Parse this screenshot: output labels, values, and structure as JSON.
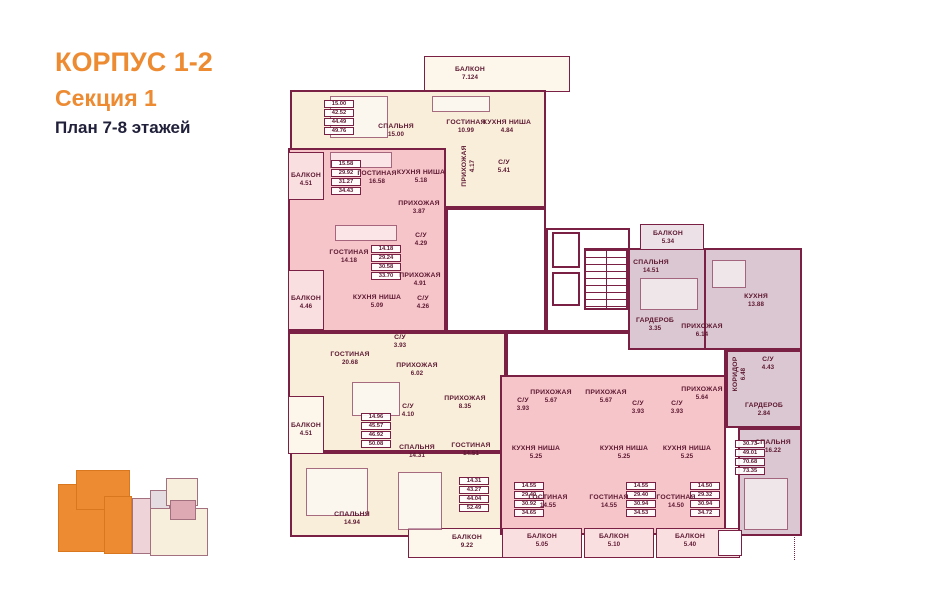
{
  "header": {
    "building": "КОРПУС 1-2",
    "section": "Секция 1",
    "plan": "План 7-8 этажей"
  },
  "palette": {
    "wall": "#7a2044",
    "label": "#5c1730",
    "orange": "#ED8B33",
    "cream": "#f8eeda",
    "pink": "#f5c5c9",
    "mauve": "#dbc7d1",
    "balcony_cream": "#fcf7ea",
    "balcony_pink": "#fadfe1",
    "balcony_mauve": "#ece1e7",
    "corridor": "#ffffff"
  },
  "plan": {
    "slabs": [
      {
        "x": 424,
        "y": 56,
        "w": 146,
        "h": 36,
        "f": "balcony_cream",
        "thin": 1,
        "n": "balcony"
      },
      {
        "x": 290,
        "y": 90,
        "w": 256,
        "h": 118,
        "f": "cream",
        "n": "apartment-zone"
      },
      {
        "x": 288,
        "y": 148,
        "w": 158,
        "h": 184,
        "f": "pink",
        "n": "apartment-zone"
      },
      {
        "x": 288,
        "y": 332,
        "w": 218,
        "h": 120,
        "f": "cream",
        "n": "apartment-zone"
      },
      {
        "x": 290,
        "y": 452,
        "w": 216,
        "h": 85,
        "f": "cream",
        "n": "apartment-zone"
      },
      {
        "x": 288,
        "y": 152,
        "w": 36,
        "h": 48,
        "f": "balcony_pink",
        "thin": 1,
        "n": "balcony"
      },
      {
        "x": 288,
        "y": 270,
        "w": 36,
        "h": 60,
        "f": "balcony_pink",
        "thin": 1,
        "n": "balcony"
      },
      {
        "x": 288,
        "y": 396,
        "w": 36,
        "h": 58,
        "f": "balcony_cream",
        "thin": 1,
        "n": "balcony"
      },
      {
        "x": 408,
        "y": 528,
        "w": 100,
        "h": 30,
        "f": "balcony_cream",
        "thin": 1,
        "n": "balcony"
      },
      {
        "x": 446,
        "y": 208,
        "w": 100,
        "h": 124,
        "f": "corridor",
        "n": "corridor"
      },
      {
        "x": 546,
        "y": 228,
        "w": 84,
        "h": 104,
        "f": "corridor",
        "n": "corridor"
      },
      {
        "x": 506,
        "y": 332,
        "w": 220,
        "h": 60,
        "f": "corridor",
        "n": "corridor"
      },
      {
        "x": 500,
        "y": 375,
        "w": 226,
        "h": 160,
        "f": "pink",
        "n": "apartment-zone"
      },
      {
        "x": 502,
        "y": 528,
        "w": 80,
        "h": 30,
        "f": "balcony_pink",
        "thin": 1,
        "n": "balcony"
      },
      {
        "x": 584,
        "y": 528,
        "w": 70,
        "h": 30,
        "f": "balcony_pink",
        "thin": 1,
        "n": "balcony"
      },
      {
        "x": 656,
        "y": 528,
        "w": 84,
        "h": 30,
        "f": "balcony_pink",
        "thin": 1,
        "n": "balcony"
      },
      {
        "x": 628,
        "y": 248,
        "w": 78,
        "h": 102,
        "f": "mauve",
        "n": "apartment-zone"
      },
      {
        "x": 704,
        "y": 248,
        "w": 98,
        "h": 102,
        "f": "mauve",
        "n": "apartment-zone"
      },
      {
        "x": 726,
        "y": 350,
        "w": 76,
        "h": 78,
        "f": "mauve",
        "n": "apartment-zone"
      },
      {
        "x": 738,
        "y": 428,
        "w": 64,
        "h": 108,
        "f": "mauve",
        "n": "apartment-zone"
      },
      {
        "x": 640,
        "y": 224,
        "w": 64,
        "h": 26,
        "f": "balcony_mauve",
        "thin": 1,
        "n": "balcony"
      },
      {
        "x": 552,
        "y": 232,
        "w": 28,
        "h": 36,
        "f": "corridor",
        "n": "elevator"
      },
      {
        "x": 552,
        "y": 272,
        "w": 28,
        "h": 34,
        "f": "corridor",
        "n": "elevator"
      },
      {
        "x": 718,
        "y": 530,
        "w": 24,
        "h": 26,
        "f": "corridor",
        "thin": 1,
        "n": "balcony"
      }
    ],
    "stairs": {
      "x": 584,
      "y": 248,
      "w": 44,
      "h": 62
    },
    "dotted": {
      "x": 794,
      "y": 534,
      "h": 26
    },
    "furniture": [
      {
        "x": 330,
        "y": 96,
        "w": 58,
        "h": 42
      },
      {
        "x": 432,
        "y": 96,
        "w": 58,
        "h": 16
      },
      {
        "x": 330,
        "y": 152,
        "w": 62,
        "h": 16
      },
      {
        "x": 335,
        "y": 225,
        "w": 62,
        "h": 16
      },
      {
        "x": 352,
        "y": 382,
        "w": 48,
        "h": 34
      },
      {
        "x": 306,
        "y": 468,
        "w": 62,
        "h": 48
      },
      {
        "x": 398,
        "y": 472,
        "w": 44,
        "h": 58
      },
      {
        "x": 640,
        "y": 278,
        "w": 58,
        "h": 32
      },
      {
        "x": 712,
        "y": 260,
        "w": 34,
        "h": 28
      },
      {
        "x": 744,
        "y": 478,
        "w": 44,
        "h": 52
      }
    ],
    "rooms": [
      {
        "l": "БАЛКОН",
        "a": "7.124",
        "x": 470,
        "y": 74
      },
      {
        "l": "СПАЛЬНЯ",
        "a": "15.00",
        "x": 396,
        "y": 131
      },
      {
        "l": "ГОСТИНАЯ",
        "a": "10.99",
        "x": 466,
        "y": 127
      },
      {
        "l": "КУХНЯ НИША",
        "a": "4.84",
        "x": 507,
        "y": 127
      },
      {
        "l": "ПРИХОЖАЯ",
        "a": "4.17",
        "x": 469,
        "y": 166,
        "v": 1
      },
      {
        "l": "С/У",
        "a": "5.41",
        "x": 504,
        "y": 167
      },
      {
        "l": "БАЛКОН",
        "a": "4.51",
        "x": 306,
        "y": 180
      },
      {
        "l": "ГОСТИНАЯ",
        "a": "16.58",
        "x": 377,
        "y": 178
      },
      {
        "l": "КУХНЯ НИША",
        "a": "5.18",
        "x": 421,
        "y": 177
      },
      {
        "l": "ПРИХОЖАЯ",
        "a": "3.87",
        "x": 419,
        "y": 208
      },
      {
        "l": "С/У",
        "a": "4.29",
        "x": 421,
        "y": 240
      },
      {
        "l": "ГОСТИНАЯ",
        "a": "14.18",
        "x": 349,
        "y": 257
      },
      {
        "l": "БАЛКОН",
        "a": "4.46",
        "x": 306,
        "y": 303
      },
      {
        "l": "КУХНЯ НИША",
        "a": "5.09",
        "x": 377,
        "y": 302
      },
      {
        "l": "ПРИХОЖАЯ",
        "a": "4.91",
        "x": 420,
        "y": 280
      },
      {
        "l": "С/У",
        "a": "4.26",
        "x": 423,
        "y": 303
      },
      {
        "l": "ГОСТИНАЯ",
        "a": "20.68",
        "x": 350,
        "y": 359
      },
      {
        "l": "С/У",
        "a": "3.93",
        "x": 400,
        "y": 342
      },
      {
        "l": "ПРИХОЖАЯ",
        "a": "6.02",
        "x": 417,
        "y": 370
      },
      {
        "l": "БАЛКОН",
        "a": "4.51",
        "x": 306,
        "y": 430
      },
      {
        "l": "С/У",
        "a": "4.10",
        "x": 408,
        "y": 411
      },
      {
        "l": "ПРИХОЖАЯ",
        "a": "8.35",
        "x": 465,
        "y": 403
      },
      {
        "l": "СПАЛЬНЯ",
        "a": "14.31",
        "x": 417,
        "y": 452
      },
      {
        "l": "ГОСТИНАЯ",
        "a": "14.51",
        "x": 471,
        "y": 450
      },
      {
        "l": "СПАЛЬНЯ",
        "a": "14.94",
        "x": 352,
        "y": 519
      },
      {
        "l": "БАЛКОН",
        "a": "9.22",
        "x": 467,
        "y": 542
      },
      {
        "l": "С/У",
        "a": "3.93",
        "x": 523,
        "y": 405
      },
      {
        "l": "ПРИХОЖАЯ",
        "a": "5.67",
        "x": 551,
        "y": 397
      },
      {
        "l": "КУХНЯ НИША",
        "a": "5.25",
        "x": 536,
        "y": 453
      },
      {
        "l": "ГОСТИНАЯ",
        "a": "14.55",
        "x": 548,
        "y": 502
      },
      {
        "l": "БАЛКОН",
        "a": "5.05",
        "x": 542,
        "y": 541
      },
      {
        "l": "ПРИХОЖАЯ",
        "a": "5.67",
        "x": 606,
        "y": 397
      },
      {
        "l": "С/У",
        "a": "3.93",
        "x": 638,
        "y": 408
      },
      {
        "l": "КУХНЯ НИША",
        "a": "5.25",
        "x": 624,
        "y": 453
      },
      {
        "l": "ГОСТИНАЯ",
        "a": "14.55",
        "x": 609,
        "y": 502
      },
      {
        "l": "БАЛКОН",
        "a": "5.10",
        "x": 614,
        "y": 541
      },
      {
        "l": "ПРИХОЖАЯ",
        "a": "5.64",
        "x": 702,
        "y": 394
      },
      {
        "l": "С/У",
        "a": "3.93",
        "x": 677,
        "y": 408
      },
      {
        "l": "КУХНЯ НИША",
        "a": "5.25",
        "x": 687,
        "y": 453
      },
      {
        "l": "ГОСТИНАЯ",
        "a": "14.50",
        "x": 676,
        "y": 502
      },
      {
        "l": "БАЛКОН",
        "a": "5.40",
        "x": 690,
        "y": 541
      },
      {
        "l": "БАЛКОН",
        "a": "5.34",
        "x": 668,
        "y": 238
      },
      {
        "l": "СПАЛЬНЯ",
        "a": "14.51",
        "x": 651,
        "y": 267
      },
      {
        "l": "ГАРДЕРОБ",
        "a": "3.35",
        "x": 655,
        "y": 325
      },
      {
        "l": "ПРИХОЖАЯ",
        "a": "6.14",
        "x": 702,
        "y": 331
      },
      {
        "l": "КУХНЯ",
        "a": "13.88",
        "x": 756,
        "y": 301
      },
      {
        "l": "КОРИДОР",
        "a": "6.48",
        "x": 740,
        "y": 374,
        "v": 1
      },
      {
        "l": "С/У",
        "a": "4.43",
        "x": 768,
        "y": 364
      },
      {
        "l": "ГАРДЕРОБ",
        "a": "2.84",
        "x": 764,
        "y": 410
      },
      {
        "l": "СПАЛЬНЯ",
        "a": "16.22",
        "x": 773,
        "y": 447
      }
    ],
    "tables": [
      {
        "x": 324,
        "y": 100,
        "rows": [
          "15.00",
          "42.52",
          "44.49",
          "49.76"
        ]
      },
      {
        "x": 331,
        "y": 160,
        "rows": [
          "15.58",
          "29.92",
          "31.27",
          "34.43"
        ]
      },
      {
        "x": 371,
        "y": 245,
        "rows": [
          "14.18",
          "29.24",
          "30.58",
          "33.70"
        ]
      },
      {
        "x": 361,
        "y": 413,
        "rows": [
          "14.96",
          "45.57",
          "46.92",
          "50.08"
        ]
      },
      {
        "x": 459,
        "y": 477,
        "rows": [
          "14.31",
          "43.27",
          "44.04",
          "52.49"
        ]
      },
      {
        "x": 514,
        "y": 482,
        "rows": [
          "14.55",
          "29.40",
          "30.92",
          "34.65"
        ]
      },
      {
        "x": 626,
        "y": 482,
        "rows": [
          "14.55",
          "29.40",
          "30.94",
          "34.53"
        ]
      },
      {
        "x": 690,
        "y": 482,
        "rows": [
          "14.50",
          "29.32",
          "30.94",
          "34.72"
        ]
      },
      {
        "x": 735,
        "y": 440,
        "rows": [
          "30.73",
          "49.01",
          "70.68",
          "73.35"
        ]
      }
    ]
  },
  "minimap": {
    "shapes": [
      {
        "x": 58,
        "y": 484,
        "w": 50,
        "h": 68,
        "c": "#ED8B33",
        "b": "#d9771f"
      },
      {
        "x": 76,
        "y": 470,
        "w": 54,
        "h": 40,
        "c": "#ED8B33",
        "b": "#d9771f"
      },
      {
        "x": 104,
        "y": 496,
        "w": 28,
        "h": 58,
        "c": "#ED8B33",
        "b": "#d9771f"
      },
      {
        "x": 132,
        "y": 498,
        "w": 34,
        "h": 56,
        "c": "#eed3d8",
        "b": "#a3707f"
      },
      {
        "x": 150,
        "y": 490,
        "w": 20,
        "h": 20,
        "c": "#e4dce0",
        "b": "#a3707f"
      },
      {
        "x": 166,
        "y": 478,
        "w": 32,
        "h": 28,
        "c": "#f7eedc",
        "b": "#a3707f"
      },
      {
        "x": 150,
        "y": 508,
        "w": 58,
        "h": 48,
        "c": "#f7eedc",
        "b": "#a3707f"
      },
      {
        "x": 170,
        "y": 500,
        "w": 26,
        "h": 20,
        "c": "#dfa9b4",
        "b": "#a3707f"
      }
    ]
  }
}
